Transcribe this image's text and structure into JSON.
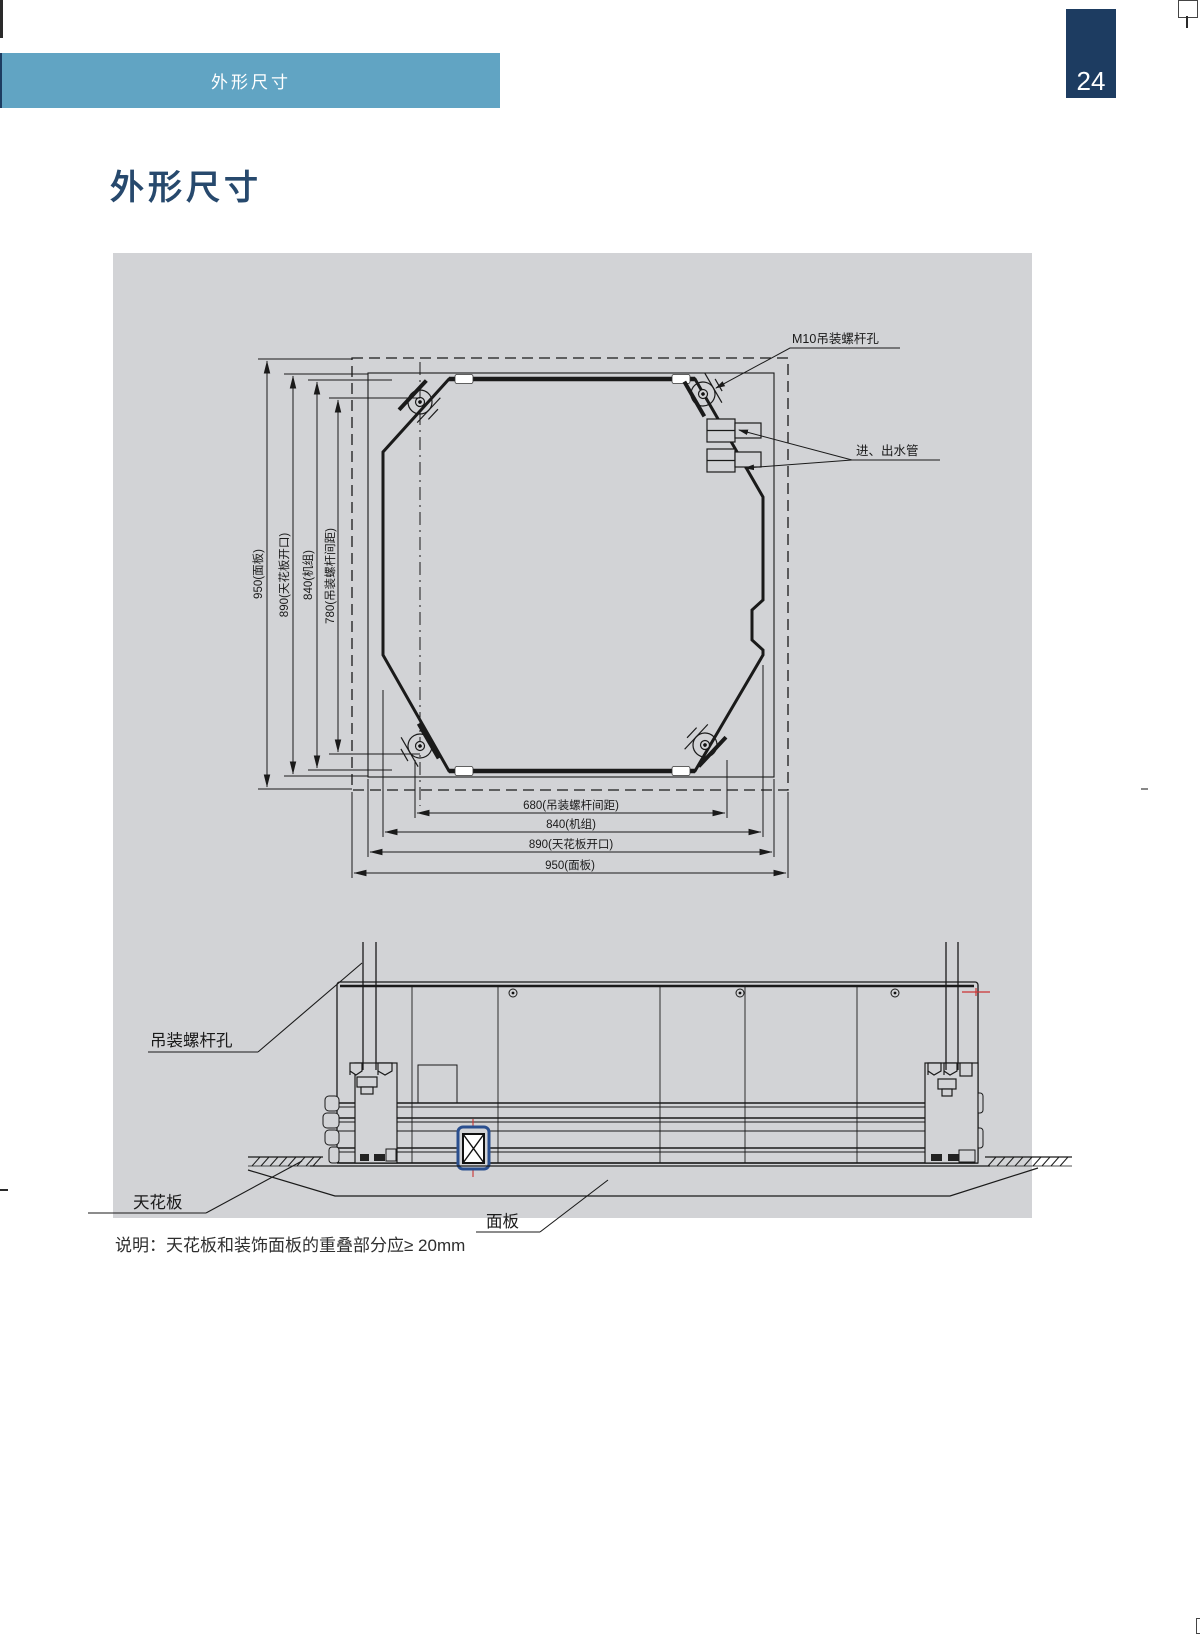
{
  "page": {
    "header_label": "外形尺寸",
    "page_number": "24",
    "title": "外形尺寸",
    "note": "说明：天花板和装饰面板的重叠部分应≥ 20mm"
  },
  "top_view": {
    "dims_vertical": [
      {
        "label": "950(面板)"
      },
      {
        "label": "890(天花板开口)"
      },
      {
        "label": "840(机组)"
      },
      {
        "label": "780(吊装螺杆间距)"
      }
    ],
    "dims_horizontal": [
      {
        "label": "680(吊装螺杆间距)"
      },
      {
        "label": "840(机组)"
      },
      {
        "label": "890(天花板开口)"
      },
      {
        "label": "950(面板)"
      }
    ],
    "annotations": {
      "screw_hole": "M10吊装螺杆孔",
      "pipes": "进、出水管"
    }
  },
  "side_view": {
    "labels": {
      "hanging_rod_hole": "吊装螺杆孔",
      "ceiling": "天花板",
      "panel": "面板"
    }
  },
  "colors": {
    "header_bar": "#61a4c3",
    "page_tab": "#1d3c61",
    "panel_background": "#d2d3d6",
    "drawing_line": "#1a1a1a",
    "highlight_red": "#cc3333",
    "component_blue": "#2a4f8f"
  }
}
